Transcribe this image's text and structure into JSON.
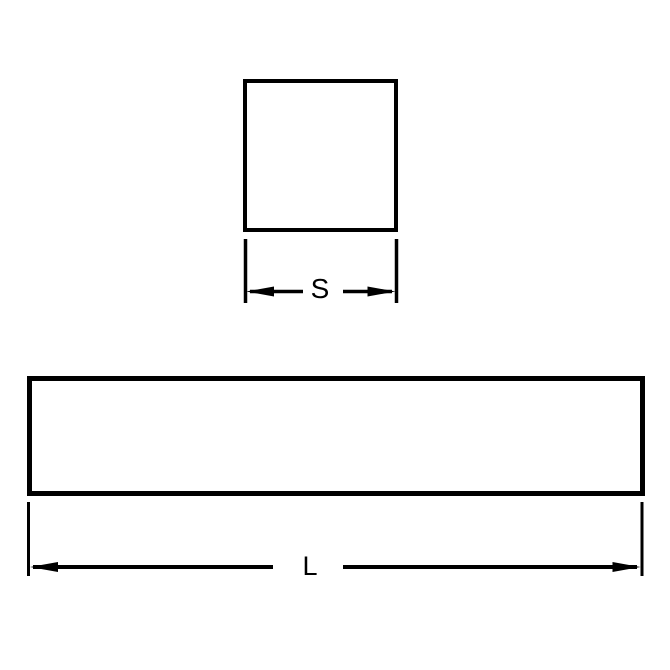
{
  "colors": {
    "line": "#000000",
    "text": "#000000",
    "background": "#ffffff"
  },
  "diagram": {
    "square_view": {
      "dim_label": "S"
    },
    "bar_view": {
      "dim_label": "L"
    }
  }
}
